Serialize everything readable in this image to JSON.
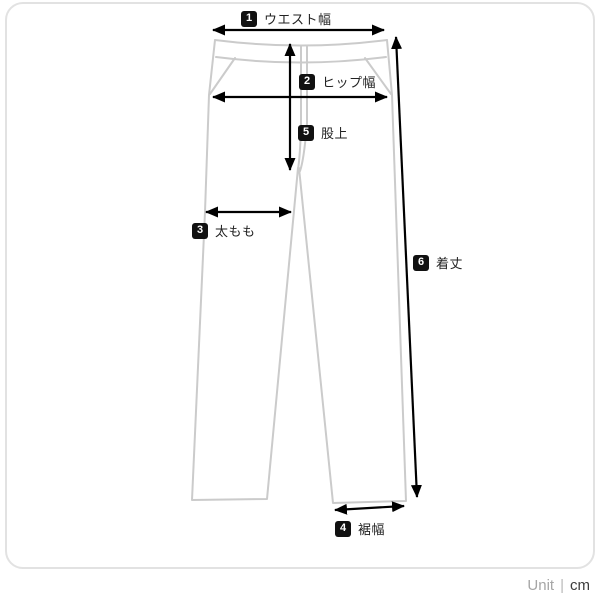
{
  "diagram": {
    "subject": "pants-size-measurement-guide",
    "measurements": [
      {
        "num": "1",
        "label": "ウエスト幅"
      },
      {
        "num": "2",
        "label": "ヒップ幅"
      },
      {
        "num": "3",
        "label": "太もも"
      },
      {
        "num": "4",
        "label": "裾幅"
      },
      {
        "num": "5",
        "label": "股上"
      },
      {
        "num": "6",
        "label": "着丈"
      }
    ]
  },
  "unit": {
    "label": "Unit",
    "separator": "|",
    "value": "cm"
  },
  "colors": {
    "garment_outline": "#cbcbcb",
    "arrow": "#000000",
    "badge_bg": "#111111",
    "badge_text": "#ffffff",
    "card_border": "#e2e2e2",
    "background": "#ffffff"
  }
}
